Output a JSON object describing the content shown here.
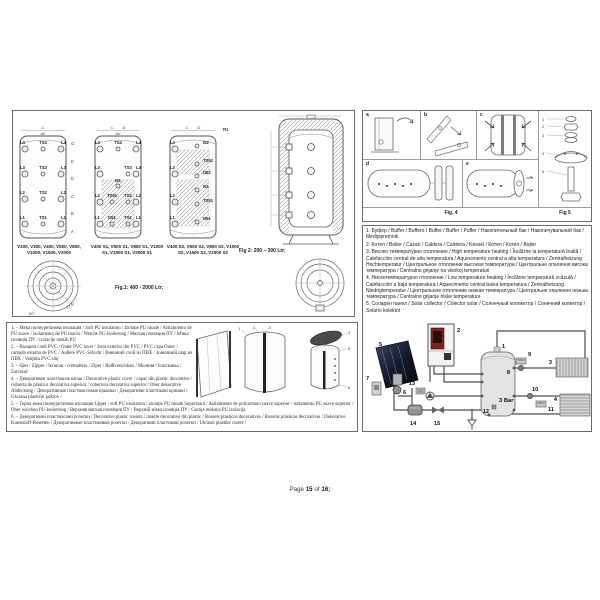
{
  "page": {
    "footer": {
      "pre": "Page",
      "num": "15",
      "mid": "of",
      "total": "16;"
    }
  },
  "fig1": {
    "caption": "Fig.1: 400 - 2000 Ltr;",
    "dim_c": "C",
    "dim_d": "D",
    "av": "AV",
    "r1": "R1",
    "side_dims": [
      "G",
      "E",
      "D",
      "C",
      "B",
      "A"
    ],
    "angle1": "22.5°",
    "angle2": "90°",
    "tank1": {
      "models": "V200, V300, V400, V500, V800, V1000, V1500, V2000",
      "rows": [
        [
          "L4",
          "TS4",
          "L4"
        ],
        [
          "L3",
          "TS3",
          "L3"
        ],
        [
          "L2",
          "TS2",
          "L2"
        ],
        [
          "L1",
          "TS1",
          "L1"
        ]
      ]
    },
    "tank2": {
      "models": "V400 S1, V500 S1, V800 S1, V1000 S1, V1500 S1, V2000 S1",
      "rows": [
        [
          "L4",
          "TS4",
          "L4"
        ],
        [
          "L3",
          "TS3",
          "L3"
        ],
        [
          "L2",
          "TS51",
          "TS2",
          "L2"
        ],
        [
          "L1",
          "D51",
          "TS1",
          "L1"
        ]
      ],
      "extra": "I51"
    },
    "tank3": {
      "models": "V400 S2, V500 S2, V800 S2, V1000 S2, V1500 S2, V2000 S2",
      "left": [
        "L4",
        "L3",
        "L2",
        "L1"
      ],
      "mid": [
        "I52",
        "TS52",
        "D52",
        "I51",
        "TS51",
        "D51"
      ]
    }
  },
  "fig2": {
    "caption": "Fig 2: 200 – 300 Ltr;"
  },
  "fig4": {
    "label": "Fig. 4",
    "panels": [
      "a",
      "b",
      "c",
      "d",
      "e"
    ]
  },
  "fig5": {
    "label": "Fig 5",
    "parts": [
      "1",
      "2",
      "3",
      "4",
      "5"
    ]
  },
  "legend": {
    "items": [
      "1. Буфер / Buffer / Buffero / Buffer / Buffer / Puffer / Накопительный бак / Накопичувальний бак / Medijspremnik",
      "2. Котел / Boiler / Cazan / Caldera / Caldeira / Kessel / Котел / Котел / Bojler",
      "3. Високо температурно отопление / High temperature heating / Încălzire la temperatură înaltă / Calefacción central de alta temperatura / Aquecimento central a alta temperatura / Zentralheizung Hochtemperatur / Центральное отопление высокая температура / Центральне опалення висока температура / Centralno grijanje na visokoj temperaturi",
      "4. Нискотемпературно отопление / Low temperature heating / Încălzire temperatură scăzută / Calefacción a baja temperatura / Aquecimento central baixa temperatura / Zentralheizung Niedrigtemperatur / Центральное отопление низкая температура / Центральне опалення низька температура / Centralno grijanje niske temperature",
      "5. Соларен панел / Solar collector / Colector solar / Солнечный коллектор / Сонячний колектор / Solarni kolektor"
    ]
  },
  "insulation": {
    "items": [
      "1. – Мека полиуретанова изолация / Soft PU insulation / Izolaţie PU moale / Aislamiento de PU suave / isolamento de PU macio / Weiche PU-Isolierung / Мягкая изоляция ПУ / М'яка ізоляція ПУ / izolacije mekih PU",
      "2. – Външен слой PVC / Outer PVC layer / Strat exterior din PVC / PVC capa Outer / camada externa de PVC / Äußere PVC-Schicht / Внешний слой из ПВХ / Зовнішній шар из ПВХ / Vanjska PVC sloj",
      "3. – Цип / Zipper / fermoar / cremallera / Zíper / Reißverschluss / Молния / Блискавка / Zatvarač",
      "4. – Декоративен пластмасов капак / Decorative plastic cover / capac din plastic decorative / cubierta de plástico decorativa superior / cobertura decorativa superior / Ober dekorative Abdeckung / Декоративные пластмассовые крышки / Декоративні пластикові кришки / Ukrasna plastični pokrov /",
      "5. – Горна мека полиуретанова изолация Upper / soft PU insulation / izolaţie PU moale Superioară / Aislamiento de poliuretano suave superior / isolamento PU suave superior / Ober weichen PU-Isolierung / Верхняя мягкая изоляция ПУ / Верхній м'яка ізоляція ПУ / Gornja mekana PU izolacija",
      "6. – Декоративни пластмасови розетки / Decorative plastic rossets / inserte decorative din plastic / Rossets plásticos decorativos / Rosetas plásticas decorativas / Dekorative Kunststoff-Rosetten / Декоративные пластиковые розетки / Декоративні пластикові розетки / Ukrasni plastike rozete /"
    ],
    "diagram_numbers": [
      "1",
      "2",
      "3",
      "4",
      "5",
      "6"
    ]
  },
  "schematic": {
    "pressure": "3 Bar",
    "n1": "1",
    "n2": "2",
    "n3": "3",
    "n4": "4",
    "n5": "5",
    "n6": "6",
    "n7": "7",
    "n8": "8",
    "n9": "9",
    "n10": "10",
    "n11": "11",
    "n12": "12",
    "n13": "13",
    "n14": "14",
    "n15": "15"
  },
  "colors": {
    "line": "#555555",
    "boiler_red": "#7e241e",
    "solar_dark": "#151b2e",
    "grey_fill": "#d9d9d9"
  }
}
